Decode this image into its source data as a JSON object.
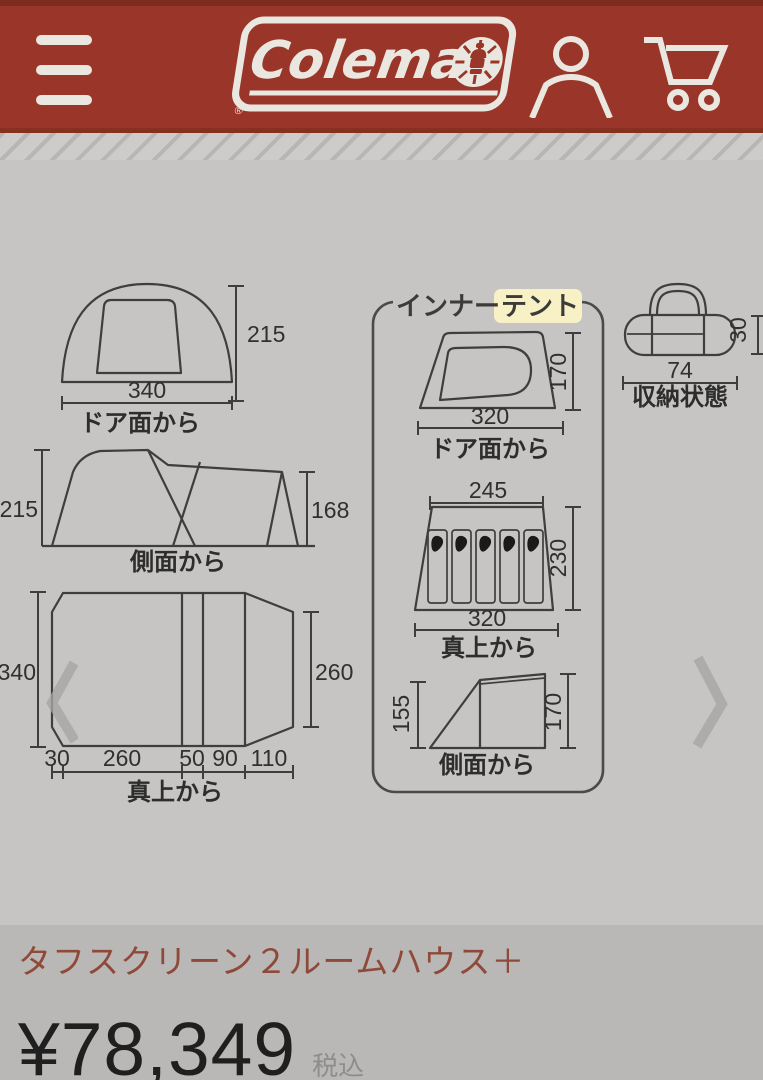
{
  "header": {
    "brand": "Coleman",
    "registered_mark": "®",
    "colors": {
      "background": "#9a3629",
      "foreground": "#eae7e0"
    },
    "icons": {
      "menu": "hamburger",
      "logo_emblem": "lantern-sunburst",
      "account": "person-silhouette",
      "cart": "shopping-cart"
    }
  },
  "carousel": {
    "prev_icon": "chevron-left",
    "next_icon": "chevron-right"
  },
  "diagram": {
    "line_color": "#3f3e3c",
    "outer_tent": {
      "front": {
        "width": "340",
        "height": "215",
        "caption": "ドア面から"
      },
      "side": {
        "left_height": "215",
        "right_height": "168",
        "caption": "側面から"
      },
      "top": {
        "left_depth": "340",
        "right_depth": "260",
        "segments": [
          "30",
          "260",
          "50",
          "90",
          "110"
        ],
        "caption": "真上から"
      }
    },
    "inner_tent": {
      "label_prefix": "インナー",
      "label_highlighted": "テント",
      "highlight_color": "#f8f1c6",
      "front": {
        "width": "320",
        "height": "170",
        "caption": "ドア面から"
      },
      "top": {
        "top_width": "245",
        "bottom_width": "320",
        "depth": "230",
        "caption": "真上から",
        "sleeping_bags": 5
      },
      "side": {
        "left_height": "155",
        "right_height": "170",
        "caption": "側面から"
      }
    },
    "storage": {
      "width": "74",
      "height": "30",
      "caption": "収納状態"
    }
  },
  "product": {
    "title": "タフスクリーン２ルームハウス＋",
    "price": "¥78,349",
    "tax_note": "税込"
  }
}
